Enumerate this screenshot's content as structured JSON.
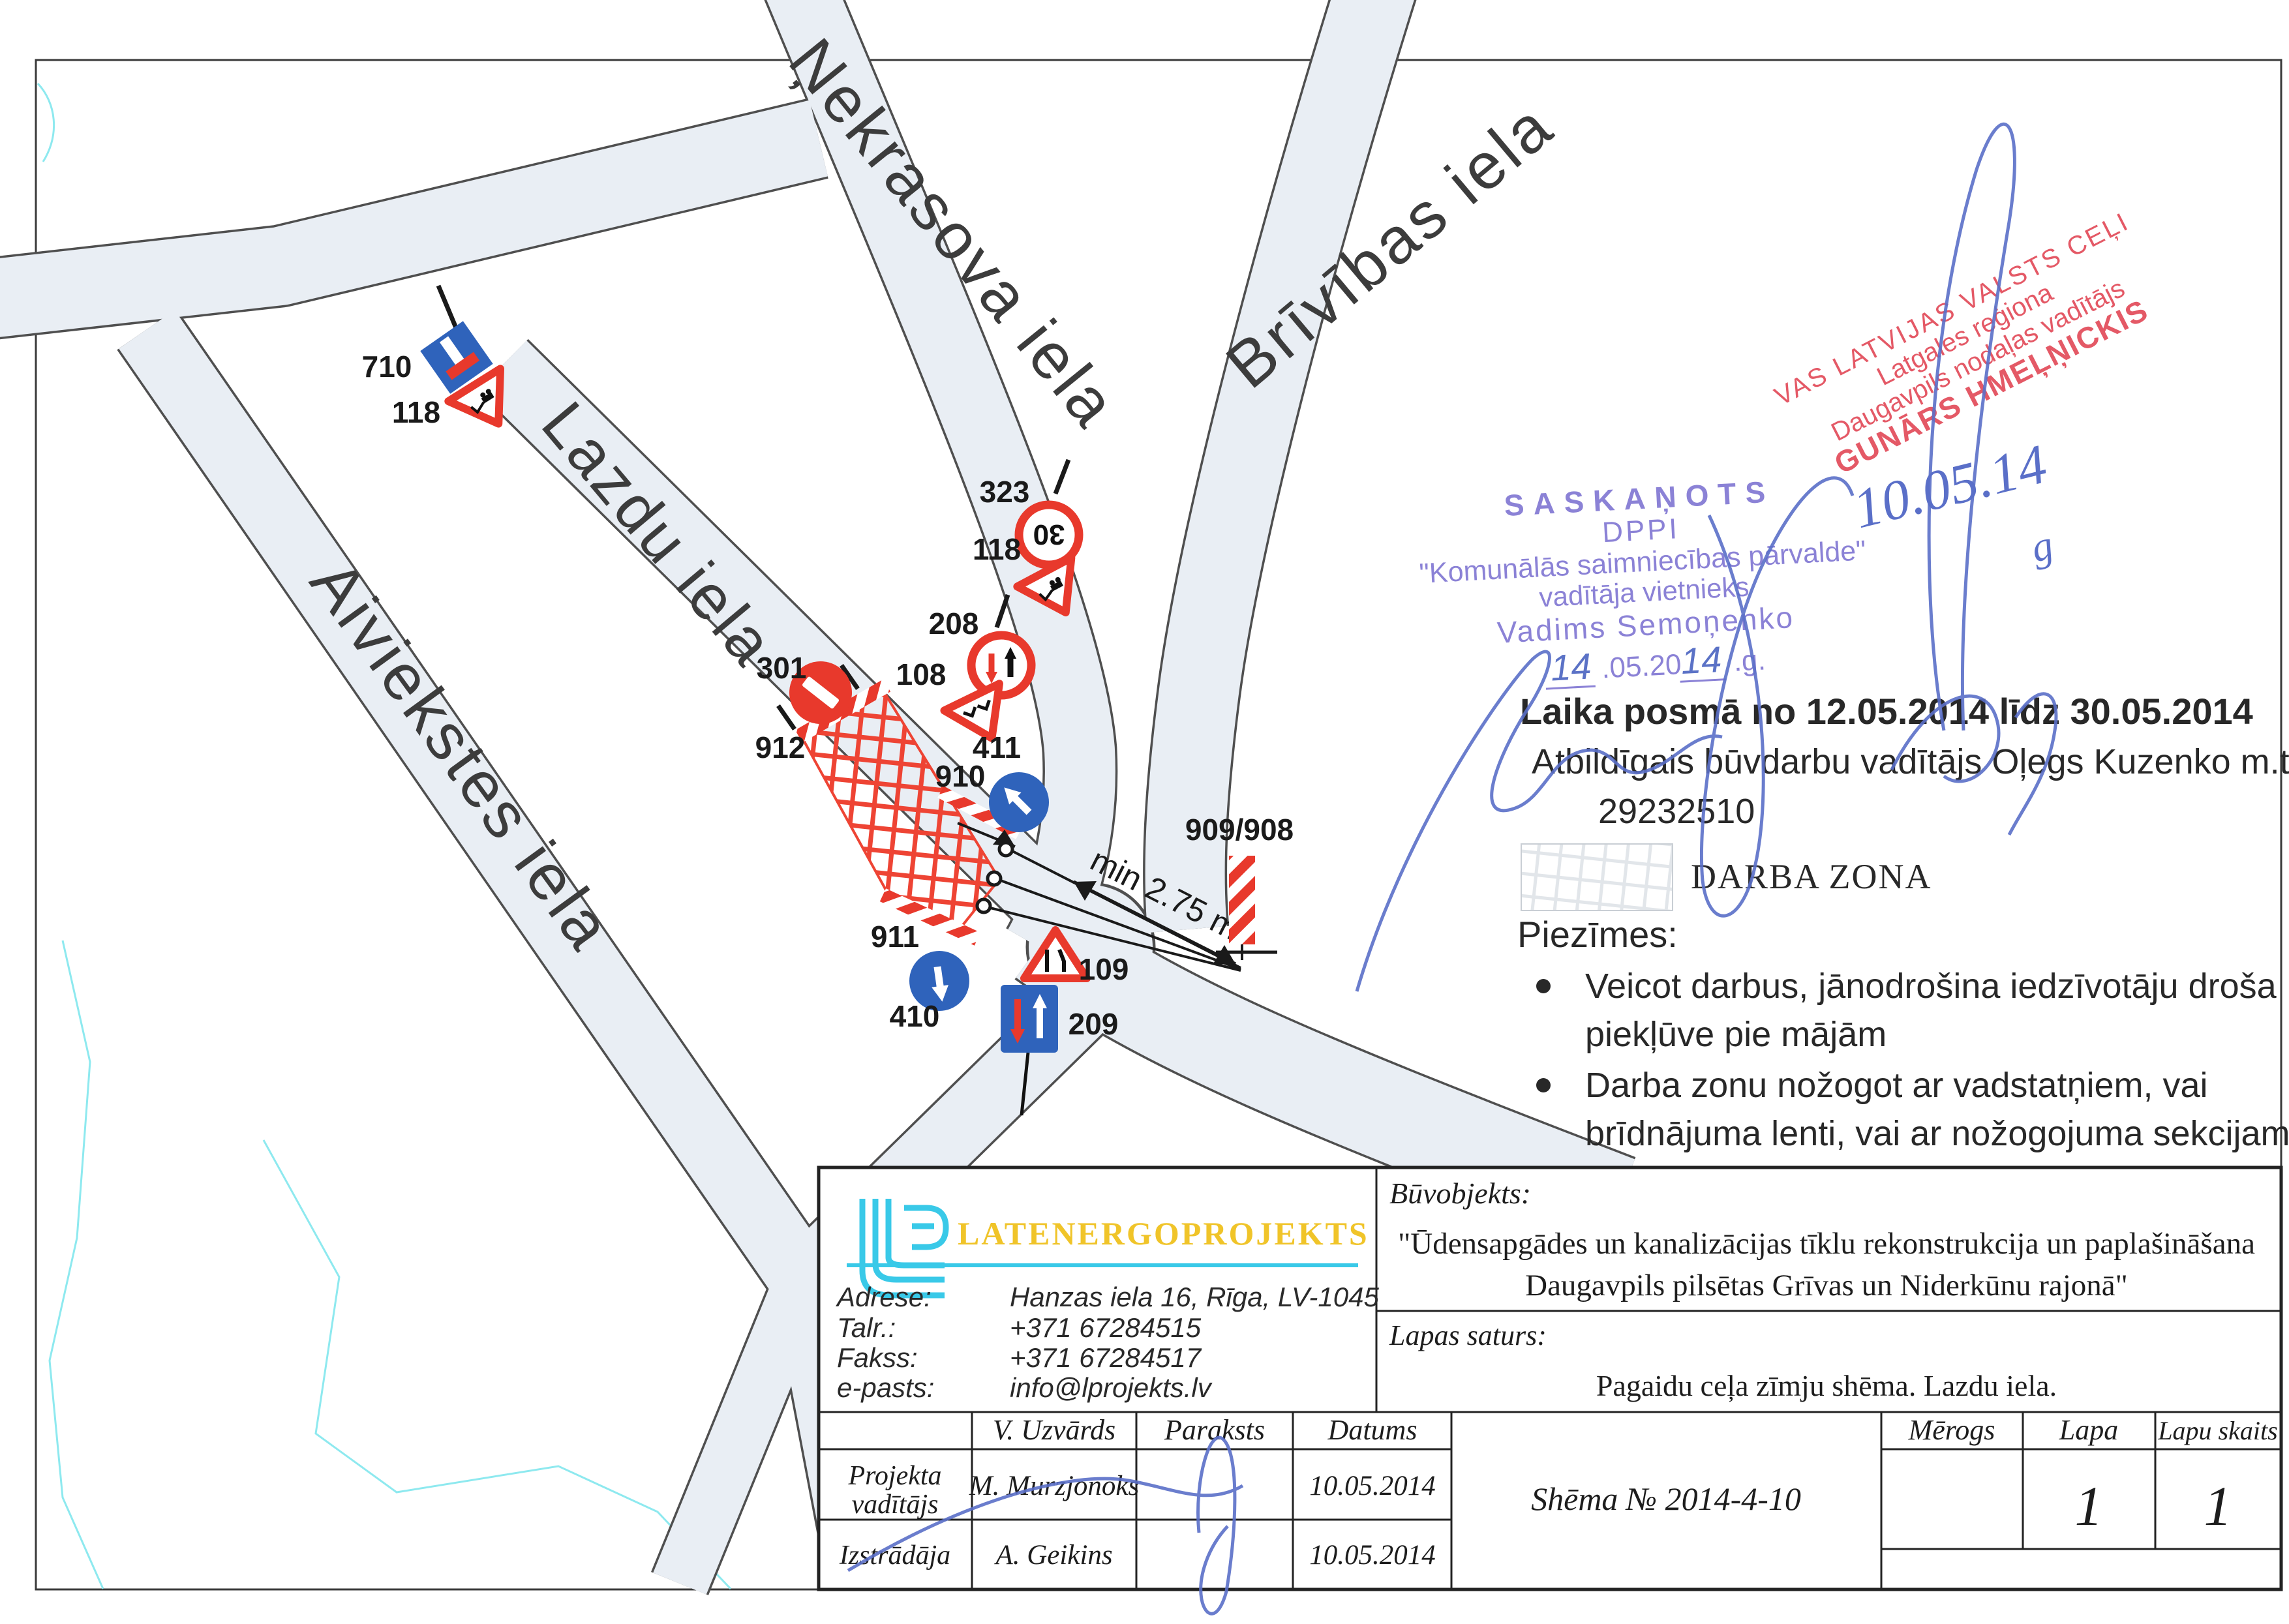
{
  "map": {
    "streets": {
      "nekrasova": "Ņekrasova iela",
      "brivibas": "Brīvības iela",
      "lazdu": "Lazdu iela",
      "aiviekstes": "Aiviekstes iela"
    },
    "signs": {
      "s710": "710",
      "s118a": "118",
      "s323": "323",
      "s118b": "118",
      "s208": "208",
      "s108": "108",
      "s301": "301",
      "s912": "912",
      "s411": "411",
      "s910": "910",
      "s911": "911",
      "s410": "410",
      "s109": "109",
      "s209": "209",
      "posts": "909/908",
      "speed30": "30"
    },
    "dimension": "min 2.75 m"
  },
  "stamps": {
    "purple": {
      "l1": "SASKAŅOTS",
      "l2": "DPPI",
      "l3": "\"Komunālās saimniecības pārvalde\"",
      "l4": "vadītāja vietnieks",
      "l5": "Vadims Semoņenko",
      "d1": "14",
      "d2": ".05.20",
      "d3": "14",
      "d4": ".g."
    },
    "red": {
      "l1": "VAS LATVIJAS VALSTS CEĻI",
      "l2": "Latgales reģiona",
      "l3": "Daugavpils nodaļas vadītājs",
      "l4": "GUNĀRS HMEĻŅICKIS",
      "date": "10.05.14",
      "date_g": "g"
    }
  },
  "notes": {
    "period": "Laika posmā no 12.05.2014 līdz 30.05.2014",
    "resp1": "Atbildīgais būvdarbu vadītājs Oļegs Kuzenko m.t.",
    "resp2": "29232510",
    "legend": "DARBA ZONA",
    "piezimes": "Piezīmes:",
    "b1l1": "Veicot darbus, jānodrošina iedzīvotāju droša",
    "b1l2": "piekļūve pie mājām",
    "b2l1": "Darba zonu nožogot ar vadstatņiem, vai",
    "b2l2": "brīdnājuma lenti, vai ar nožogojuma sekcijam"
  },
  "title_block": {
    "company": {
      "name": "LATENERGOPROJEKTS",
      "adrese_label": "Adrese:",
      "adrese": "Hanzas iela 16, Rīga, LV-1045",
      "talr_label": "Talr.:",
      "talr": "+371 67284515",
      "fakss_label": "Fakss:",
      "fakss": "+371 67284517",
      "epasts_label": "e-pasts:",
      "epasts": "info@lprojekts.lv"
    },
    "buvobjekts_label": "Būvobjekts:",
    "buvobjekts_l1": "\"Ūdensapgādes un kanalizācijas tīklu rekonstrukcija un paplašināšana",
    "buvobjekts_l2": "Daugavpils pilsētas Grīvas un Niderkūnu rajonā\"",
    "lapas_label": "Lapas saturs:",
    "lapas_content": "Pagaidu ceļa zīmju shēma. Lazdu iela.",
    "table": {
      "uzvards": "V. Uzvārds",
      "paraksts": "Paraksts",
      "datums": "Datums",
      "row1_role_l1": "Projekta",
      "row1_role_l2": "vadītājs",
      "row1_name": "M. Murzjonoks",
      "row1_date": "10.05.2014",
      "row2_role": "Izstrādāja",
      "row2_name": "A. Geikins",
      "row2_date": "10.05.2014"
    },
    "shema": "Shēma № 2014-4-10",
    "merogs": "Mērogs",
    "lapa": "Lapa",
    "lapa_val": "1",
    "lapu_skaits": "Lapu skaits",
    "lapu_skaits_val": "1"
  }
}
